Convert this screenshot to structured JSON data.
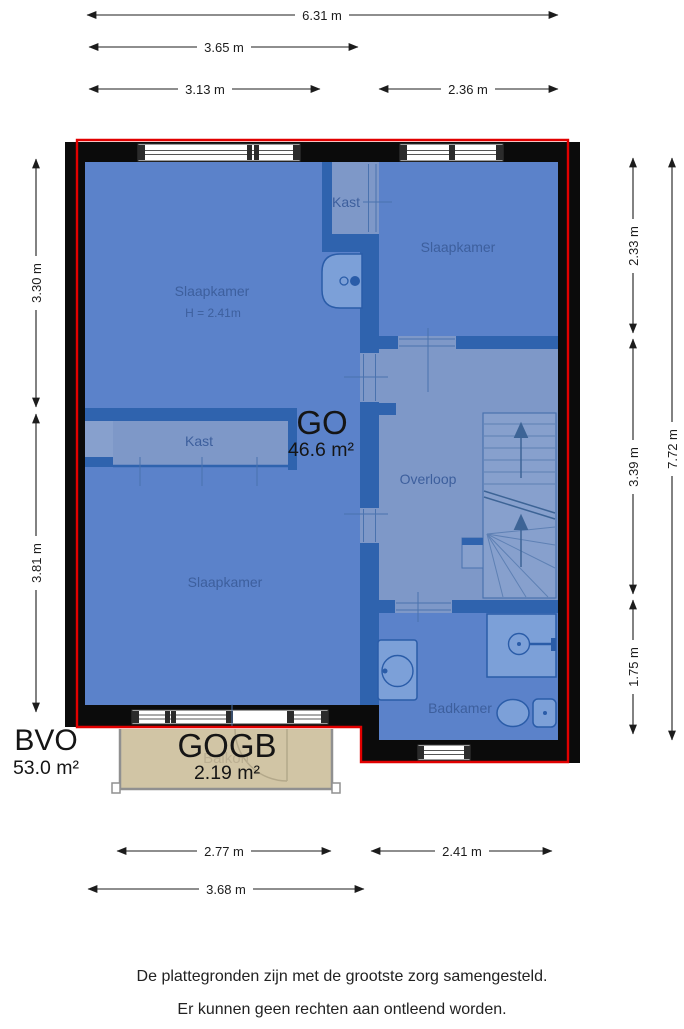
{
  "dims": {
    "width_total": "6.31 m",
    "width_upper": "3.65 m",
    "width_upper_left": "3.13 m",
    "width_upper_right": "2.36 m",
    "height_left_top": "3.30 m",
    "height_left_bottom": "3.81 m",
    "height_right_top": "2.33 m",
    "height_right_middle": "3.39 m",
    "height_right_bottom": "1.75 m",
    "height_right_total": "7.72 m",
    "width_balcony": "2.77 m",
    "width_bathroom": "2.41 m",
    "width_bottom": "3.68 m"
  },
  "rooms": {
    "slaapkamer_left": "Slaapkamer",
    "slaapkamer_left_height": "H = 2.41m",
    "slaapkamer_right": "Slaapkamer",
    "kast_top": "Kast",
    "kast_long": "Kast",
    "overloop": "Overloop",
    "slaapkamer_bottom": "Slaapkamer",
    "badkamer": "Badkamer",
    "balkon": "Balkon"
  },
  "areas": {
    "go_label": "GO",
    "go_value": "46.6 m²",
    "bvo_label": "BVO",
    "bvo_value": "53.0 m²",
    "gogb_label": "GOGB",
    "gogb_value": "2.19 m²"
  },
  "footer": {
    "line1": "De plattegronden zijn met de grootste zorg samengesteld.",
    "line2": "Er kunnen geen rechten aan ontleend worden."
  },
  "colors": {
    "floor": "#5b82ca",
    "floor_secondary": "#7e98c8",
    "wall": "#0b0b0b",
    "inner_wall": "#2f63ae",
    "bvo_outline": "#e10000",
    "balcony": "#d1c5a5",
    "label_text": "#3d5f9d"
  }
}
